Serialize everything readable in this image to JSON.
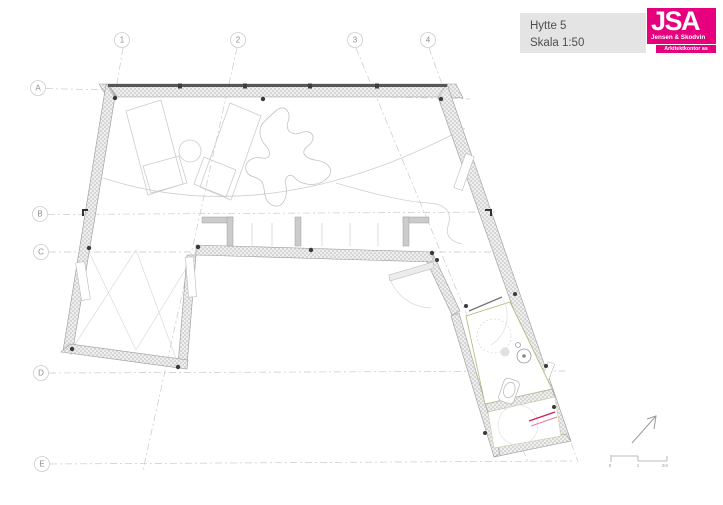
{
  "title_block": {
    "project": "Hytte 5",
    "scale": "Skala 1:50"
  },
  "logo": {
    "acronym": "JSA",
    "firm_line1": "Jensen & Skodvin",
    "firm_line2": "Arkitektkontor as",
    "brand_color": "#e6007e"
  },
  "grid": {
    "rows": [
      "A",
      "B",
      "C",
      "D",
      "E"
    ],
    "cols": [
      "1",
      "2",
      "3",
      "4"
    ]
  },
  "scale_bar": {
    "labels": [
      "0",
      "1",
      "2m"
    ]
  },
  "colors": {
    "wall_fill": "#dadada",
    "wall_edge": "#9a9a9a",
    "glass_dark": "#555555",
    "grid_line": "#c9c9c9",
    "furniture_line": "#cccccc",
    "floor_trim_olive": "#b5b577",
    "accent_red": "#cf2050",
    "accent_pink": "#e87ba2",
    "title_bg": "#e4e4e4",
    "title_text": "#4f4f4f"
  }
}
